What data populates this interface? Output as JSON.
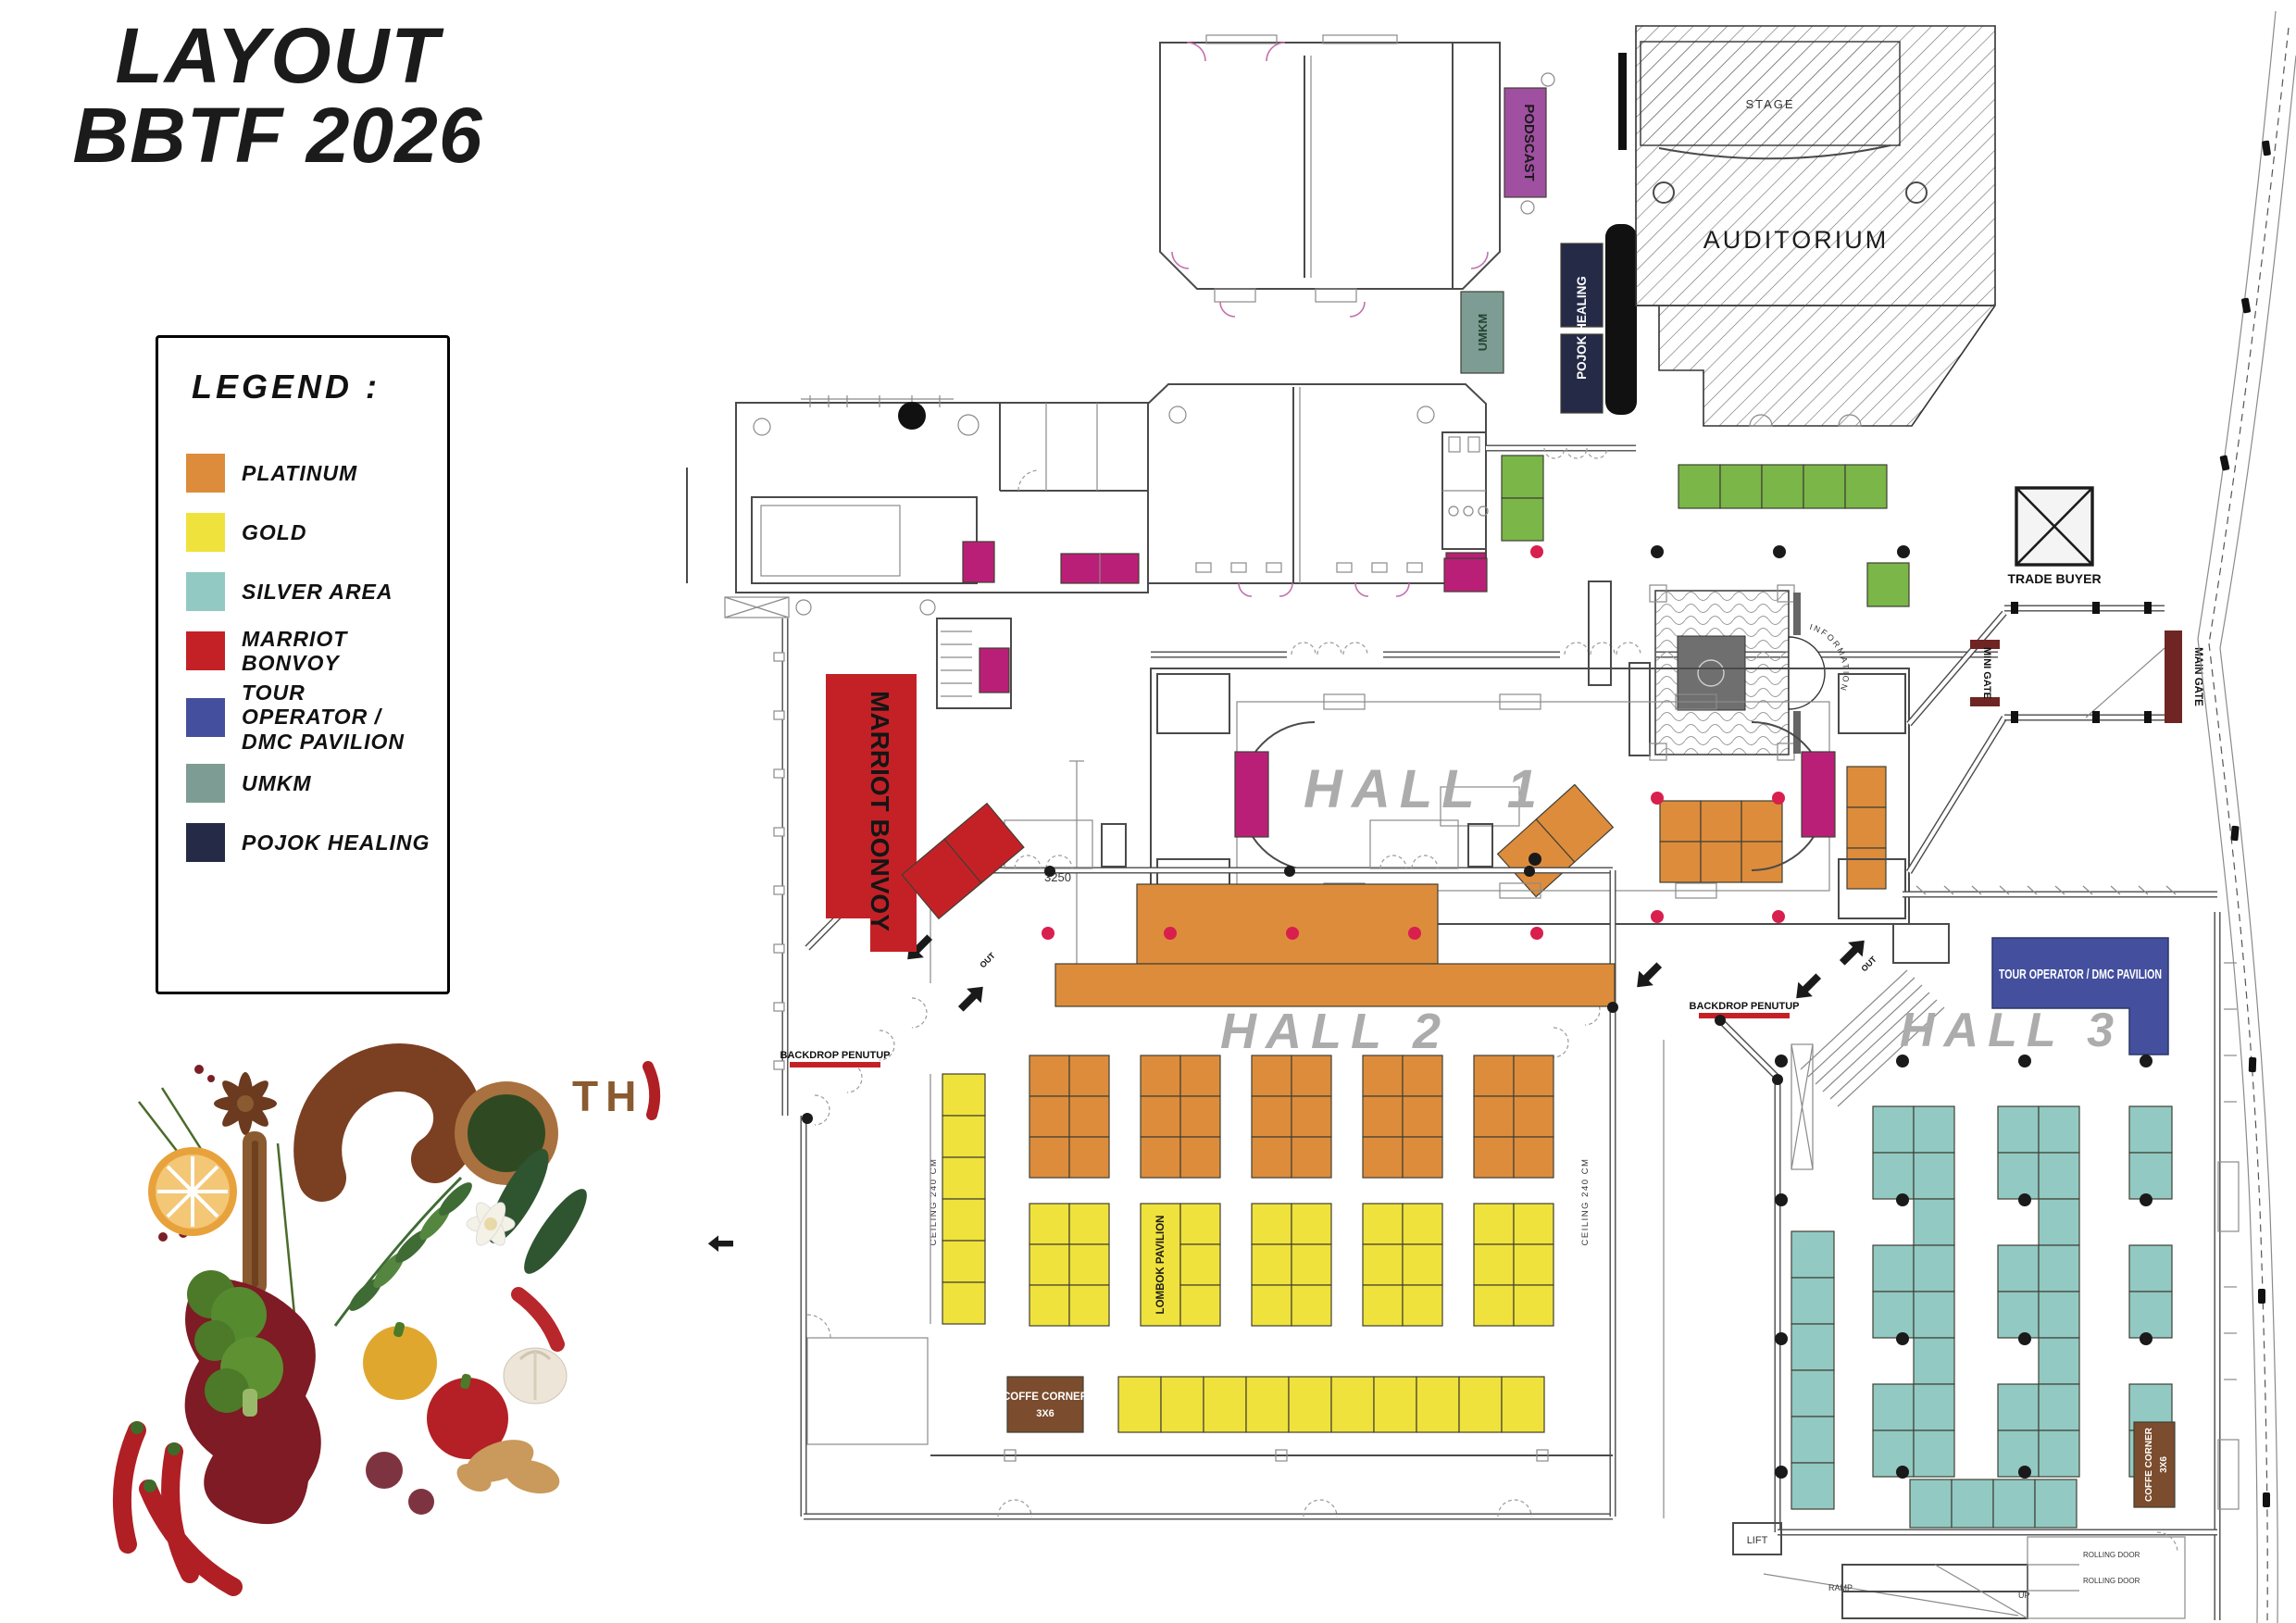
{
  "title": {
    "line1": "LAYOUT",
    "line2": "BBTF 2026"
  },
  "legend": {
    "heading": "LEGEND :",
    "items": [
      {
        "label": "PLATINUM",
        "color": "#DD8C3C"
      },
      {
        "label": "GOLD",
        "color": "#F0E23C"
      },
      {
        "label": "SILVER AREA",
        "color": "#92C9C3"
      },
      {
        "label": "MARRIOT BONVOY",
        "color": "#C42127"
      },
      {
        "label": "TOUR OPERATOR / DMC PAVILION",
        "color": "#44509E"
      },
      {
        "label": "UMKM",
        "color": "#7D9D94"
      },
      {
        "label": "POJOK HEALING",
        "color": "#252A47"
      }
    ]
  },
  "plan": {
    "hall1": "HALL 1",
    "hall2": "HALL 2",
    "hall3": "HALL 3",
    "auditorium": "AUDITORIUM",
    "stage": "STAGE",
    "podcast": "PODSCAST",
    "pojok_healing": "POJOK HEALING",
    "umkm": "UMKM",
    "marriot_bonvoy": "MARRIOT BONVOY",
    "tour_operator": "TOUR OPERATOR / DMC PAVILION",
    "lombok_pavilion": "LOMBOK PAVILION",
    "trade_buyer": "TRADE BUYER",
    "mini_gate": "MINI GATE",
    "main_gate": "MAIN GATE",
    "backdrop_penutup": "BACKDROP PENUTUP",
    "coffee_corner_l1": "COFFE CORNER",
    "coffee_corner_l2": "3X6",
    "information": "INFORMATION",
    "ceiling_note": "CEILING 240 CM",
    "lift": "LIFT",
    "ramp": "RAMP",
    "up": "UP",
    "out": "OUT",
    "rolling_door": "ROLLING DOOR",
    "dim_3250": "3250"
  },
  "anniversary": {
    "number": "12",
    "suffix": "TH"
  },
  "colors": {
    "platinum": "#DD8C3C",
    "gold": "#F0E23C",
    "silver_area": "#92C9C3",
    "marriot_bonvoy": "#C42127",
    "tour_operator_dmc": "#44509E",
    "umkm": "#7D9D94",
    "pojok_healing": "#252A47",
    "green_booth": "#7AB648",
    "magenta_booth": "#BA1F77",
    "podcast_purple": "#A050A0",
    "coffee_brown": "#7B4C2D",
    "gate_maroon": "#6E2523",
    "dot_red": "#D81F4D",
    "hall_label_gray": "#ACACAC"
  }
}
